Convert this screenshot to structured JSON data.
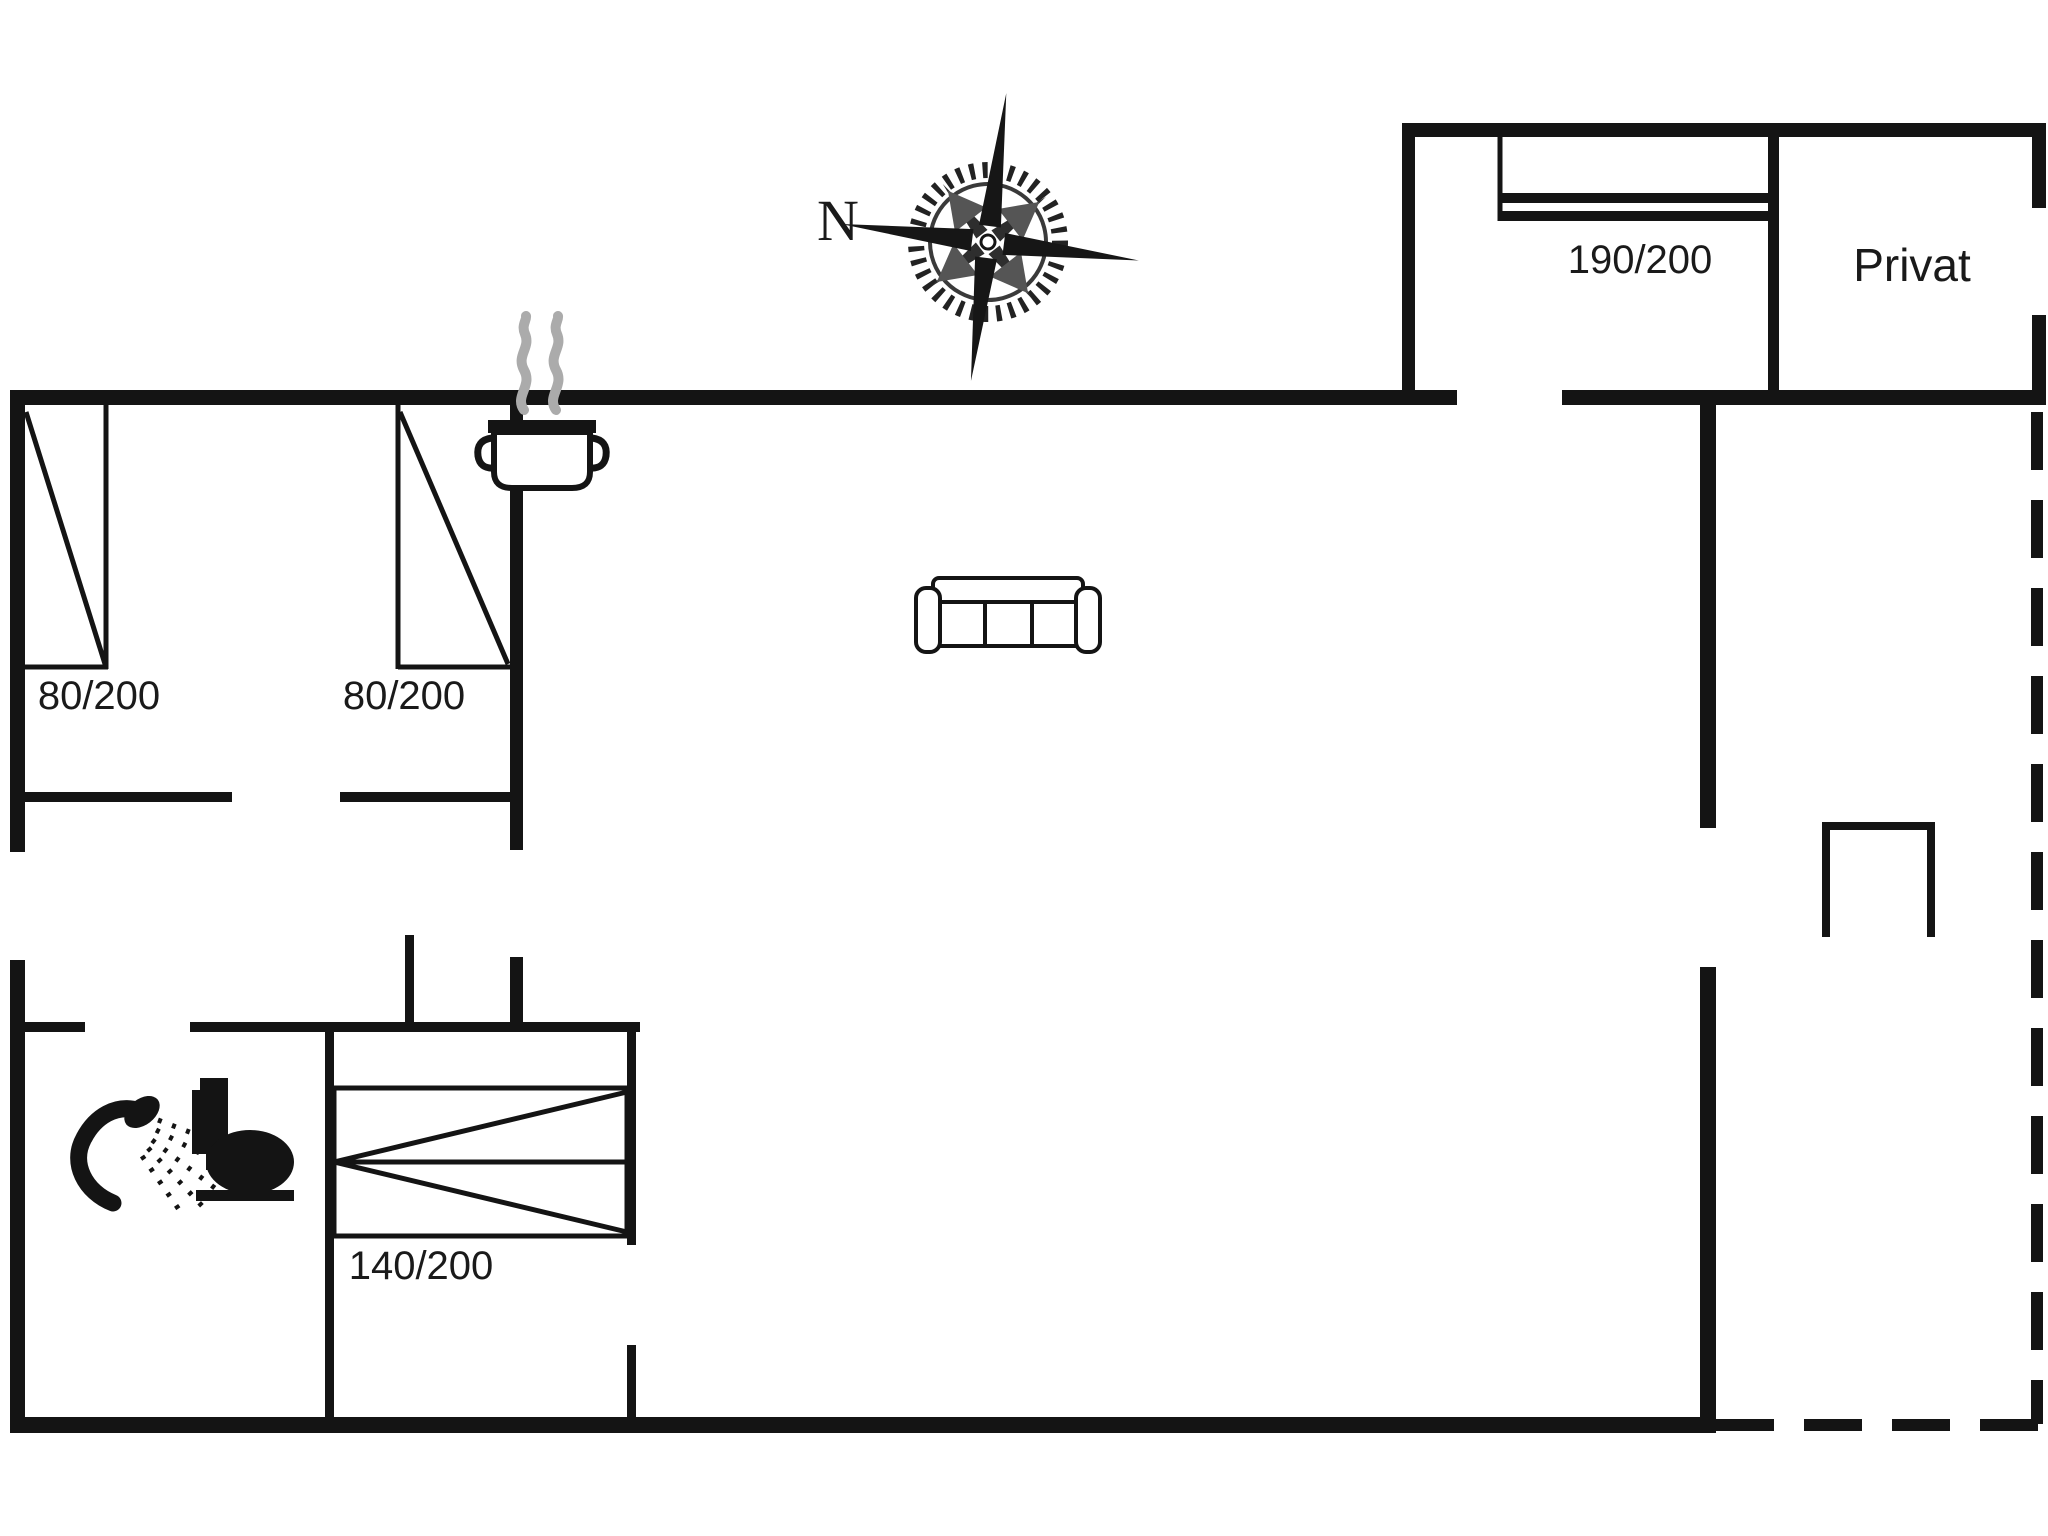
{
  "document": {
    "type": "floor-plan",
    "background": "#ffffff"
  },
  "compass": {
    "north_label": "N"
  },
  "rooms": {
    "annex_bedroom": {
      "bed_size_label": "190/200"
    },
    "private_room": {
      "label": "Privat"
    },
    "double_bedroom": {
      "bed_left_size_label": "80/200",
      "bed_right_size_label": "80/200"
    },
    "small_bedroom": {
      "bed_size_label": "140/200"
    },
    "bathroom": {
      "fixtures": [
        "shower",
        "toilet"
      ]
    },
    "living_area": {
      "furniture": [
        "sofa",
        "cooking-pot"
      ]
    },
    "terrace": {
      "boundary_style": "dashed"
    }
  },
  "icons": [
    "compass-rose-icon",
    "steam-pot-icon",
    "sofa-icon",
    "shower-icon",
    "toilet-icon"
  ],
  "colors": {
    "wall": "#141414",
    "steam": "#ababab",
    "text": "#1a1a1a",
    "background": "#ffffff"
  }
}
